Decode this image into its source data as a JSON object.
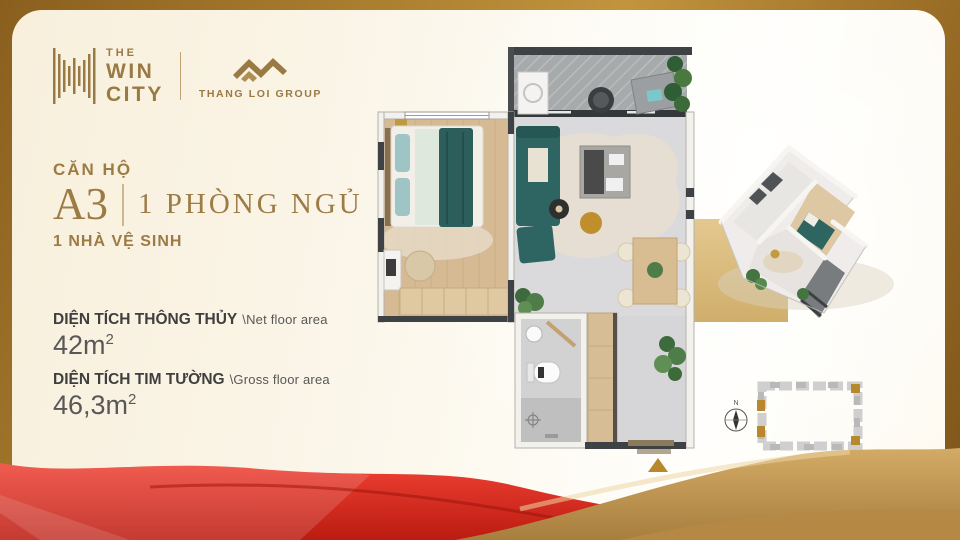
{
  "brand": {
    "the": "THE",
    "win": "WIN",
    "city": "CITY",
    "partner": "THANG LOI GROUP"
  },
  "unit": {
    "category": "CĂN HỘ",
    "code": "A3",
    "bedroom": "1 PHÒNG NGỦ",
    "bathroom": "1 NHÀ VỆ SINH"
  },
  "areas": {
    "net": {
      "vi": "DIỆN TÍCH THÔNG THỦY",
      "en": "\\Net floor area",
      "value": "42m",
      "sup": "2"
    },
    "gross": {
      "vi": "DIỆN TÍCH TIM TƯỜNG",
      "en": "\\Gross floor area",
      "value": "46,3m",
      "sup": "2"
    }
  },
  "siteplan": {
    "compass": "N"
  },
  "colors": {
    "gold_text": "#9c7b45",
    "frame_gold": "#9a6d26",
    "accent_red": "#d92b1d",
    "wave_gold": "#c49a55",
    "cream": "#faf3e2",
    "sofa_teal": "#2e6562",
    "wood": "#d5ba94"
  }
}
